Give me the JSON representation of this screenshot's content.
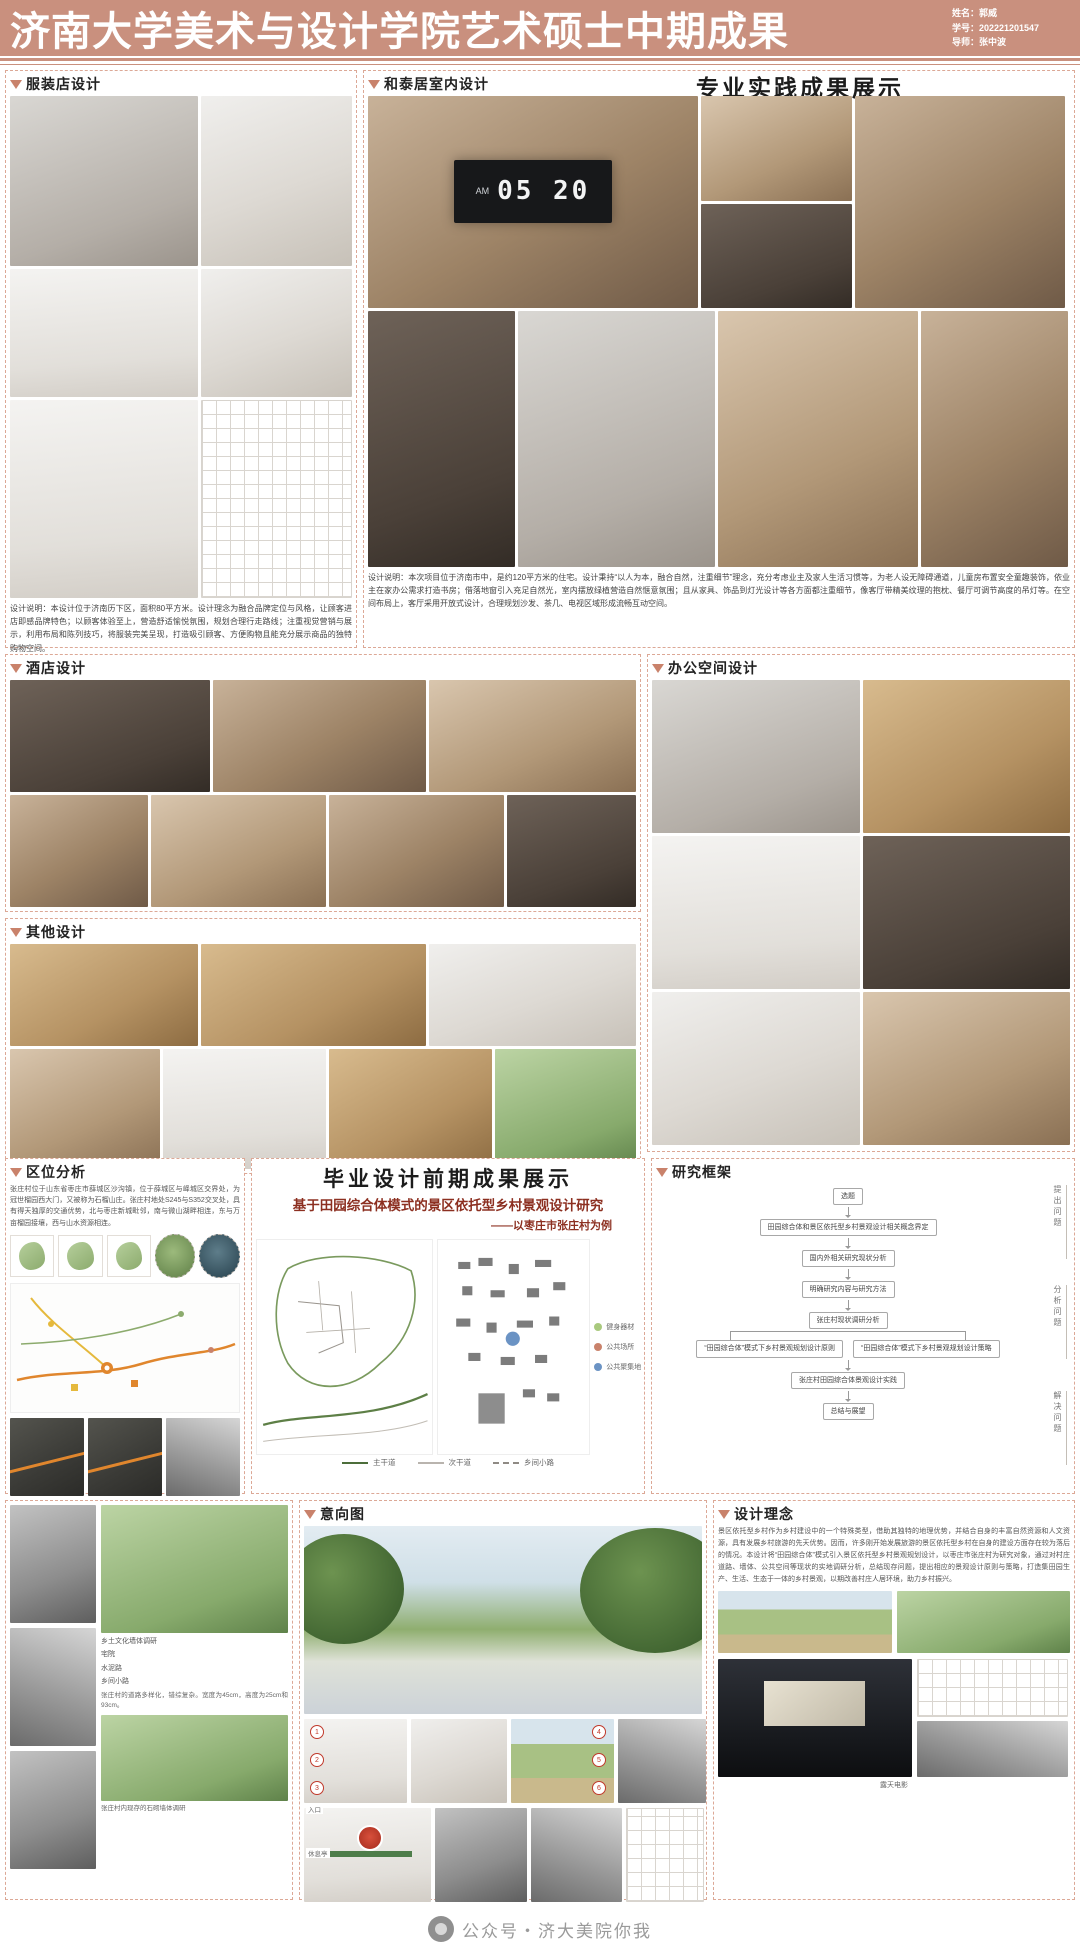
{
  "header": {
    "title": "济南大学美术与设计学院艺术硕士中期成果",
    "name": "姓名：郭威",
    "student_id": "学号：202221201547",
    "advisor": "导师：张中波"
  },
  "practice": {
    "heading": "专业实践成果展示"
  },
  "clothing": {
    "label": "服装店设计",
    "desc": "设计说明：本设计位于济南历下区，面积80平方米。设计理念为融合品牌定位与风格，让顾客进店即感品牌特色；以顾客体验至上，营造舒适愉悦氛围，规划合理行走路线；注重视觉营销与展示，利用布局和陈列技巧，将服装完美呈现，打造吸引顾客、方便购物且能充分展示商品的独特购物空间。"
  },
  "hetai": {
    "label": "和泰居室内设计",
    "clock_am": "AM",
    "clock_time": "05 20",
    "desc": "设计说明：本次项目位于济南市中，是约120平方米的住宅。设计秉持“以人为本，融合自然，注重细节”理念，充分考虑业主及家人生活习惯等，为老人设无障碍通道，儿童房布置安全童趣装饰，依业主在家办公需求打造书房；借落地窗引入充足自然光，室内摆放绿植营造自然惬意氛围；且从家具、饰品到灯光设计等各方面都注重细节，像客厅带精美纹理的抱枕、餐厅可调节高度的吊灯等。在空间布局上，客厅采用开放式设计，合理规划沙发、茶几、电视区域形成流畅互动空间。"
  },
  "hotel": {
    "label": "酒店设计"
  },
  "office": {
    "label": "办公空间设计"
  },
  "other": {
    "label": "其他设计"
  },
  "location": {
    "label": "区位分析",
    "desc": "张庄村位于山东省枣庄市薛城区沙沟镇，位于薛城区与峄城区交界处，为冠世榴园西大门，又被称为石榴山庄。张庄村地处S245与S352交叉处，具有得天独厚的交通优势，北与枣庄新城毗邻，南与微山湖畔相连，东与万亩榴园接壤，西与山水资源相连。"
  },
  "graduation": {
    "heading": "毕业设计前期成果展示",
    "title": "基于田园综合体模式的景区依托型乡村景观设计研究",
    "subtitle": "——以枣庄市张庄村为例",
    "road_legend": [
      {
        "label": "主干道"
      },
      {
        "label": "次干道"
      },
      {
        "label": "乡间小路"
      }
    ],
    "point_legend": [
      {
        "label": "健身器材",
        "color": "#a9c97e"
      },
      {
        "label": "公共场所",
        "color": "#c9826b"
      },
      {
        "label": "公共聚集地",
        "color": "#6b93c4"
      }
    ]
  },
  "framework": {
    "label": "研究框架",
    "nodes": {
      "n1": "选题",
      "n2": "田园综合体和景区依托型乡村景观设计相关概念界定",
      "n3": "国内外相关研究现状分析",
      "n4": "明确研究内容与研究方法",
      "n5": "张庄村现状调研分析",
      "n6a": "“田园综合体”模式下乡村景观规划设计原则",
      "n6b": "“田园综合体”模式下乡村景观规划设计策略",
      "n7": "张庄村田园综合体景观设计实践",
      "n8": "总结与展望"
    },
    "side_labels": [
      "提出问题",
      "分析问题",
      "解决问题"
    ]
  },
  "survey": {
    "captions": [
      "乡土文化墙体调研",
      "宅院",
      "水泥路",
      "乡间小路"
    ],
    "note1": "张庄村的道路多样化，错综复杂。宽度为45cm，高度为25cm和93cm。",
    "note2": "张庄村内现存的石砌墙体调研"
  },
  "intention": {
    "label": "意向图",
    "markers": [
      "1",
      "2",
      "3",
      "4",
      "5",
      "6"
    ],
    "tags": [
      "入口",
      "休息亭"
    ]
  },
  "concept": {
    "label": "设计理念",
    "desc": "景区依托型乡村作为乡村建设中的一个特殊类型，借助其独特的地理优势，并结合自身的丰富自然资源和人文资源，具有发展乡村旅游的先天优势。因而，许多刚开始发展旅游的景区依托型乡村在自身的建设方面存在较为落后的情况。本设计将“田园综合体”模式引入景区依托型乡村景观规划设计，以枣庄市张庄村为研究对象，通过对村庄道路、墙体、公共空间等现状的实地调研分析，总结现存问题，提出相应的景观设计原则与策略，打造集田园生产、生活、生态于一体的乡村景观，以期改善村庄人居环境，助力乡村振兴。",
    "photo_caption": "露天电影"
  },
  "watermark": {
    "text": "公众号・济大美院你我"
  }
}
